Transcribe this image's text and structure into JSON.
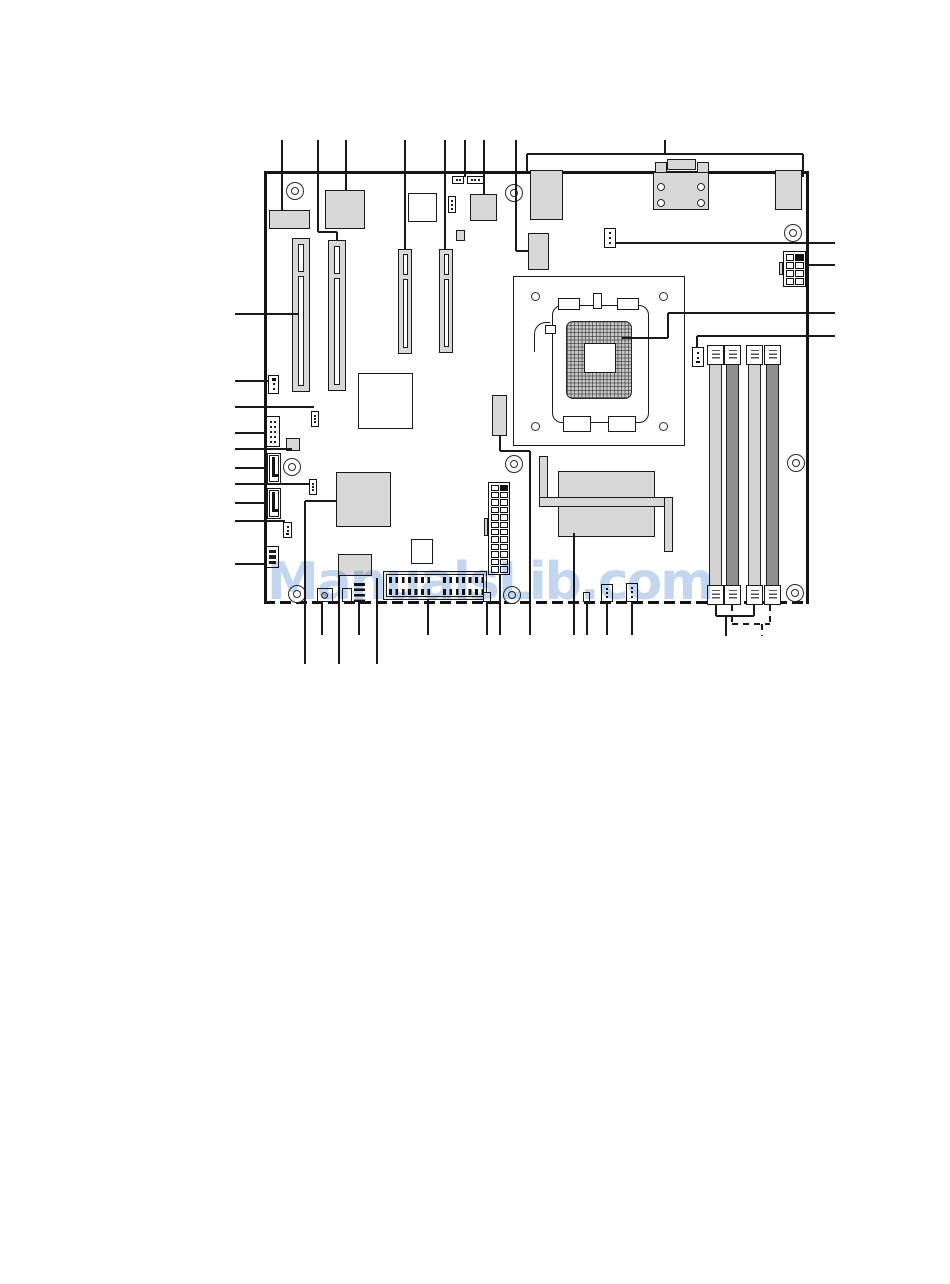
{
  "page": {
    "width": 950,
    "height": 1284,
    "background": "#ffffff"
  },
  "watermark": {
    "text": "ManualsLib.com",
    "color": "#c3d6f0",
    "x": 267,
    "y": 556
  },
  "colors": {
    "line": "#1a1a1a",
    "board_edge": "#151515",
    "block_fill": "#d8d8d8",
    "dimm_light": "#d2d2d2",
    "dimm_dark": "#8f8f8f",
    "hatch_fill": "#c7c7c7"
  },
  "board": {
    "x": 264,
    "y": 171,
    "w": 544,
    "h": 433,
    "bottom_style": "dashed"
  },
  "mount_holes": [
    [
      295,
      191
    ],
    [
      514,
      193
    ],
    [
      793,
      233
    ],
    [
      292,
      467
    ],
    [
      514,
      464
    ],
    [
      796,
      463
    ],
    [
      297,
      594
    ],
    [
      512,
      595
    ],
    [
      795,
      593
    ]
  ],
  "components": [
    {
      "n": "rear-io-port-left",
      "t": "r",
      "f": "g",
      "b": [
        269,
        210,
        41,
        19
      ]
    },
    {
      "n": "lan-controller-chip",
      "t": "r",
      "f": "g",
      "b": [
        325,
        190,
        40,
        39
      ]
    },
    {
      "n": "chip-outline-top",
      "t": "r",
      "f": "w",
      "b": [
        408,
        193,
        29,
        29
      ]
    },
    {
      "n": "jumper-block-a",
      "t": "hdr",
      "b": [
        452,
        176,
        12,
        8
      ],
      "c": 2,
      "r": 1
    },
    {
      "n": "jumper-block-b",
      "t": "hdr",
      "b": [
        467,
        176,
        17,
        8
      ],
      "c": 3,
      "r": 1
    },
    {
      "n": "jumper-3pin-top",
      "t": "hdr",
      "b": [
        448,
        196,
        8,
        17
      ],
      "c": 1,
      "r": 3,
      "dk": "b"
    },
    {
      "n": "clock-chip",
      "t": "r",
      "f": "g",
      "b": [
        470,
        194,
        27,
        27
      ]
    },
    {
      "n": "chip-small-top",
      "t": "r",
      "f": "g",
      "b": [
        456,
        230,
        9,
        11
      ]
    },
    {
      "n": "rear-io-port-usb",
      "t": "r",
      "f": "g",
      "b": [
        530,
        170,
        33,
        50
      ]
    },
    {
      "n": "connector-block-mid",
      "t": "r",
      "f": "g",
      "b": [
        528,
        233,
        21,
        37
      ]
    },
    {
      "n": "serial-port-tab-left",
      "t": "r",
      "f": "g",
      "b": [
        655,
        162,
        12,
        11
      ]
    },
    {
      "n": "serial-port-top",
      "t": "r",
      "f": "g",
      "b": [
        667,
        159,
        29,
        11
      ]
    },
    {
      "n": "serial-port-tab-right",
      "t": "r",
      "f": "g",
      "b": [
        697,
        162,
        12,
        11
      ]
    },
    {
      "n": "serial-port-body",
      "t": "r",
      "f": "g",
      "b": [
        653,
        172,
        56,
        38
      ]
    },
    {
      "n": "serial-port-screw",
      "t": "circ",
      "b": [
        661,
        187,
        4
      ]
    },
    {
      "n": "serial-port-screw",
      "t": "circ",
      "b": [
        661,
        203,
        4
      ]
    },
    {
      "n": "serial-port-screw",
      "t": "circ",
      "b": [
        701,
        187,
        4
      ]
    },
    {
      "n": "serial-port-screw",
      "t": "circ",
      "b": [
        701,
        203,
        4
      ]
    },
    {
      "n": "rear-io-port-right",
      "t": "r",
      "f": "g",
      "b": [
        775,
        170,
        27,
        40
      ]
    },
    {
      "n": "fan-header-rear",
      "t": "hdr",
      "b": [
        604,
        228,
        12,
        20
      ],
      "c": 1,
      "r": 3
    },
    {
      "n": "cpu-power-8pin",
      "t": "grid",
      "b": [
        783,
        251,
        23,
        36
      ],
      "c": 2,
      "r": 4,
      "dark": [
        1
      ]
    },
    {
      "n": "cpu-power-tab",
      "t": "r",
      "f": "g",
      "b": [
        779,
        262,
        4,
        13
      ]
    },
    {
      "n": "pci-slot-1",
      "t": "r",
      "f": "g",
      "b": [
        292,
        238,
        18,
        154
      ]
    },
    {
      "n": "pci-slot-1-key",
      "t": "r",
      "f": "w",
      "b": [
        298,
        244,
        6,
        28
      ]
    },
    {
      "n": "pci-slot-1-main",
      "t": "r",
      "f": "w",
      "b": [
        298,
        276,
        6,
        110
      ]
    },
    {
      "n": "pci-slot-2",
      "t": "r",
      "f": "g",
      "b": [
        328,
        240,
        18,
        151
      ]
    },
    {
      "n": "pci-slot-2-key",
      "t": "r",
      "f": "w",
      "b": [
        334,
        246,
        6,
        28
      ]
    },
    {
      "n": "pci-slot-2-main",
      "t": "r",
      "f": "w",
      "b": [
        334,
        278,
        6,
        107
      ]
    },
    {
      "n": "pcie-slot-1",
      "t": "r",
      "f": "g",
      "b": [
        398,
        249,
        14,
        105
      ]
    },
    {
      "n": "pcie-slot-1-key",
      "t": "r",
      "f": "w",
      "b": [
        403,
        254,
        5,
        21
      ]
    },
    {
      "n": "pcie-slot-1-main",
      "t": "r",
      "f": "w",
      "b": [
        403,
        279,
        5,
        69
      ]
    },
    {
      "n": "pcie-slot-2",
      "t": "r",
      "f": "g",
      "b": [
        439,
        249,
        14,
        104
      ]
    },
    {
      "n": "pcie-slot-2-key",
      "t": "r",
      "f": "w",
      "b": [
        444,
        254,
        5,
        21
      ]
    },
    {
      "n": "pcie-slot-2-main",
      "t": "r",
      "f": "w",
      "b": [
        444,
        279,
        5,
        68
      ]
    },
    {
      "n": "cpu-socket-outline",
      "t": "r",
      "f": "w",
      "b": [
        513,
        276,
        172,
        170
      ]
    },
    {
      "n": "socket-corner-hole",
      "t": "circ",
      "b": [
        535,
        296,
        4.5
      ]
    },
    {
      "n": "socket-corner-hole",
      "t": "circ",
      "b": [
        663,
        296,
        4.5
      ]
    },
    {
      "n": "socket-corner-hole",
      "t": "circ",
      "b": [
        535,
        426,
        4.5
      ]
    },
    {
      "n": "socket-corner-hole",
      "t": "circ",
      "b": [
        663,
        426,
        4.5
      ]
    },
    {
      "n": "cpu-socket-body",
      "t": "round",
      "b": [
        552,
        305,
        97,
        118
      ]
    },
    {
      "n": "socket-cam-left",
      "t": "r",
      "f": "w",
      "b": [
        558,
        298,
        22,
        12
      ]
    },
    {
      "n": "socket-cam-right",
      "t": "r",
      "f": "w",
      "b": [
        617,
        298,
        22,
        12
      ]
    },
    {
      "n": "socket-pin-tab",
      "t": "r",
      "f": "w",
      "b": [
        593,
        293,
        9,
        16
      ]
    },
    {
      "n": "socket-lever",
      "t": "corner",
      "b": [
        534,
        322,
        16,
        30
      ]
    },
    {
      "n": "socket-lever-tab",
      "t": "r",
      "f": "w",
      "b": [
        545,
        325,
        11,
        9
      ]
    },
    {
      "n": "cpu-pad-array",
      "t": "hatch",
      "b": [
        566,
        321,
        66,
        78
      ]
    },
    {
      "n": "cpu-pad-center",
      "t": "r",
      "f": "w",
      "b": [
        584,
        343,
        32,
        30
      ]
    },
    {
      "n": "socket-tab-bottom-left",
      "t": "r",
      "f": "w",
      "b": [
        563,
        416,
        28,
        16
      ]
    },
    {
      "n": "socket-tab-bottom-right",
      "t": "r",
      "f": "w",
      "b": [
        608,
        416,
        28,
        16
      ]
    },
    {
      "n": "dimm-slot-1",
      "t": "r",
      "f": "l",
      "b": [
        709,
        345,
        13,
        260
      ]
    },
    {
      "n": "dimm-slot-2",
      "t": "r",
      "f": "k",
      "b": [
        726,
        345,
        13,
        260
      ]
    },
    {
      "n": "dimm-slot-3",
      "t": "r",
      "f": "l",
      "b": [
        748,
        345,
        13,
        260
      ]
    },
    {
      "n": "dimm-slot-4",
      "t": "r",
      "f": "k",
      "b": [
        766,
        345,
        13,
        260
      ]
    },
    {
      "n": "dimm-latch",
      "t": "latch",
      "b": [
        707,
        345,
        17,
        20
      ]
    },
    {
      "n": "dimm-latch",
      "t": "latch",
      "b": [
        724,
        345,
        17,
        20
      ]
    },
    {
      "n": "dimm-latch",
      "t": "latch",
      "b": [
        746,
        345,
        17,
        20
      ]
    },
    {
      "n": "dimm-latch",
      "t": "latch",
      "b": [
        764,
        345,
        17,
        20
      ]
    },
    {
      "n": "dimm-latch",
      "t": "latch",
      "b": [
        707,
        585,
        17,
        20
      ]
    },
    {
      "n": "dimm-latch",
      "t": "latch",
      "b": [
        724,
        585,
        17,
        20
      ]
    },
    {
      "n": "dimm-latch",
      "t": "latch",
      "b": [
        746,
        585,
        17,
        20
      ]
    },
    {
      "n": "dimm-latch",
      "t": "latch",
      "b": [
        764,
        585,
        17,
        20
      ]
    },
    {
      "n": "fan-header-memory",
      "t": "hdr",
      "b": [
        692,
        347,
        12,
        20
      ],
      "c": 1,
      "r": 3,
      "dk": "b"
    },
    {
      "n": "vrm-bar",
      "t": "r",
      "f": "g",
      "b": [
        492,
        395,
        15,
        41
      ]
    },
    {
      "n": "heatsink-block",
      "t": "r",
      "f": "g",
      "b": [
        558,
        471,
        97,
        66
      ]
    },
    {
      "n": "heatpipe-left",
      "t": "r",
      "f": "g",
      "b": [
        539,
        456,
        9,
        47
      ]
    },
    {
      "n": "heatpipe-bottom",
      "t": "r",
      "f": "g",
      "b": [
        539,
        497,
        134,
        10
      ]
    },
    {
      "n": "heatpipe-right",
      "t": "r",
      "f": "g",
      "b": [
        664,
        497,
        9,
        55
      ]
    },
    {
      "n": "atx-power-24pin",
      "t": "grid",
      "b": [
        488,
        482,
        22,
        93
      ],
      "c": 2,
      "r": 12,
      "dark": [
        1
      ]
    },
    {
      "n": "atx-power-tab",
      "t": "r",
      "f": "g",
      "b": [
        484,
        518,
        4,
        18
      ]
    },
    {
      "n": "northbridge-chip",
      "t": "r",
      "f": "w",
      "b": [
        358,
        373,
        55,
        56
      ]
    },
    {
      "n": "southbridge-chip",
      "t": "r",
      "f": "g",
      "b": [
        336,
        472,
        55,
        55
      ]
    },
    {
      "n": "io-controller-chip",
      "t": "r",
      "f": "g",
      "b": [
        338,
        554,
        34,
        22
      ]
    },
    {
      "n": "bios-chip",
      "t": "r",
      "f": "w",
      "b": [
        411,
        539,
        22,
        25
      ]
    },
    {
      "n": "header-4pin-left",
      "t": "hdr",
      "b": [
        268,
        375,
        11,
        19
      ],
      "c": 1,
      "r": 3,
      "dk": "t"
    },
    {
      "n": "jumper-a",
      "t": "hdr",
      "b": [
        311,
        411,
        8,
        16
      ],
      "c": 1,
      "r": 3
    },
    {
      "n": "header-2x5-left",
      "t": "hdr",
      "b": [
        266,
        416,
        14,
        31
      ],
      "c": 2,
      "r": 5
    },
    {
      "n": "chip-square-left",
      "t": "r",
      "f": "g",
      "b": [
        286,
        438,
        14,
        13
      ]
    },
    {
      "n": "sata-connector-1",
      "t": "r",
      "f": "w",
      "b": [
        267,
        453,
        14,
        31
      ]
    },
    {
      "n": "sata-1-inner",
      "t": "r",
      "f": "w",
      "b": [
        269,
        455,
        10,
        27
      ]
    },
    {
      "n": "sata-1-key",
      "t": "r",
      "f": "d",
      "b": [
        272,
        457,
        3,
        19
      ]
    },
    {
      "n": "sata-1-foot",
      "t": "r",
      "f": "d",
      "b": [
        272,
        474,
        6,
        3
      ]
    },
    {
      "n": "jumper-b",
      "t": "hdr",
      "b": [
        309,
        479,
        8,
        16
      ],
      "c": 1,
      "r": 3
    },
    {
      "n": "sata-connector-2",
      "t": "r",
      "f": "w",
      "b": [
        267,
        488,
        14,
        31
      ]
    },
    {
      "n": "sata-2-inner",
      "t": "r",
      "f": "w",
      "b": [
        269,
        490,
        10,
        27
      ]
    },
    {
      "n": "sata-2-key",
      "t": "r",
      "f": "d",
      "b": [
        272,
        492,
        3,
        19
      ]
    },
    {
      "n": "sata-2-foot",
      "t": "r",
      "f": "d",
      "b": [
        272,
        509,
        6,
        3
      ]
    },
    {
      "n": "header-3pin-left",
      "t": "hdr",
      "b": [
        283,
        522,
        9,
        16
      ],
      "c": 1,
      "r": 3,
      "dk": "b"
    },
    {
      "n": "header-2x3-left",
      "t": "hdr",
      "b": [
        266,
        546,
        13,
        22
      ],
      "c": 2,
      "r": 3,
      "big": true
    },
    {
      "n": "conn-bottom-1",
      "t": "r",
      "f": "w",
      "b": [
        317,
        588,
        16,
        14
      ]
    },
    {
      "n": "conn-bottom-1-dot",
      "t": "circ",
      "b": [
        324,
        595,
        3.5
      ],
      "f": "g"
    },
    {
      "n": "conn-bottom-2",
      "t": "r",
      "f": "w",
      "b": [
        342,
        588,
        10,
        14
      ]
    },
    {
      "n": "audio-header-bars",
      "t": "bars",
      "b": [
        354,
        581,
        11,
        21
      ]
    },
    {
      "n": "front-panel-connector",
      "t": "r",
      "f": "e",
      "b": [
        383,
        571,
        104,
        29
      ]
    },
    {
      "n": "front-panel-inner",
      "t": "r",
      "f": "w",
      "b": [
        386,
        574,
        98,
        23
      ]
    },
    {
      "n": "front-panel-pins",
      "t": "pins",
      "b": [
        389,
        577,
        45,
        6
      ]
    },
    {
      "n": "front-panel-pins",
      "t": "pins",
      "b": [
        443,
        577,
        40,
        6
      ]
    },
    {
      "n": "front-panel-pins",
      "t": "pins",
      "b": [
        389,
        589,
        45,
        6
      ]
    },
    {
      "n": "front-panel-pins",
      "t": "pins",
      "b": [
        443,
        589,
        40,
        6
      ]
    },
    {
      "n": "conn-2pin-bottom",
      "t": "r",
      "f": "w",
      "b": [
        483,
        592,
        8,
        10
      ]
    },
    {
      "n": "conn-tiny-bottom",
      "t": "r",
      "f": "w",
      "b": [
        583,
        592,
        7,
        10
      ]
    },
    {
      "n": "conn-io-1",
      "t": "hdr",
      "b": [
        601,
        584,
        12,
        18
      ],
      "c": 1,
      "r": 3
    },
    {
      "n": "conn-io-2",
      "t": "hdr",
      "b": [
        626,
        583,
        12,
        19
      ],
      "c": 1,
      "r": 3
    }
  ],
  "callout_lines": [
    [
      282,
      140,
      282,
      210
    ],
    [
      318,
      140,
      318,
      232
    ],
    [
      318,
      232,
      337,
      232
    ],
    [
      337,
      232,
      337,
      240
    ],
    [
      346,
      140,
      346,
      190
    ],
    [
      405,
      140,
      405,
      249
    ],
    [
      445,
      140,
      445,
      249
    ],
    [
      465,
      140,
      465,
      177
    ],
    [
      484,
      140,
      484,
      194
    ],
    [
      516,
      140,
      516,
      251
    ],
    [
      516,
      251,
      528,
      251
    ],
    [
      665,
      140,
      665,
      154
    ],
    [
      527,
      154,
      803,
      154
    ],
    [
      527,
      154,
      527,
      172
    ],
    [
      803,
      154,
      803,
      177
    ],
    [
      616,
      243,
      835,
      243
    ],
    [
      806,
      265,
      835,
      265
    ],
    [
      622,
      338,
      668,
      338
    ],
    [
      668,
      313,
      668,
      338
    ],
    [
      668,
      313,
      835,
      313
    ],
    [
      697,
      336,
      835,
      336
    ],
    [
      697,
      336,
      697,
      347
    ],
    [
      235,
      314,
      298,
      314
    ],
    [
      235,
      381,
      268,
      381
    ],
    [
      235,
      407,
      314,
      407
    ],
    [
      235,
      433,
      266,
      433
    ],
    [
      235,
      449,
      292,
      449
    ],
    [
      235,
      468,
      267,
      468
    ],
    [
      235,
      484,
      309,
      484
    ],
    [
      235,
      503,
      267,
      503
    ],
    [
      235,
      521,
      285,
      521
    ],
    [
      235,
      564,
      266,
      564
    ],
    [
      305,
      501,
      336,
      501
    ],
    [
      305,
      501,
      305,
      664
    ],
    [
      322,
      602,
      322,
      635
    ],
    [
      339,
      576,
      339,
      664
    ],
    [
      359,
      602,
      359,
      635
    ],
    [
      377,
      578,
      377,
      664
    ],
    [
      428,
      600,
      428,
      635
    ],
    [
      487,
      602,
      487,
      635
    ],
    [
      500,
      575,
      500,
      635
    ],
    [
      500,
      436,
      500,
      451
    ],
    [
      500,
      451,
      530,
      451
    ],
    [
      530,
      451,
      530,
      635
    ],
    [
      574,
      533,
      574,
      635
    ],
    [
      587,
      602,
      587,
      635
    ],
    [
      607,
      602,
      607,
      635
    ],
    [
      632,
      602,
      632,
      635
    ],
    [
      716,
      605,
      716,
      616
    ],
    [
      754,
      605,
      754,
      616
    ],
    [
      716,
      616,
      754,
      616
    ],
    [
      726,
      616,
      726,
      636
    ],
    [
      732,
      605,
      732,
      624,
      1
    ],
    [
      770,
      605,
      770,
      624,
      1
    ],
    [
      732,
      624,
      770,
      624,
      1
    ],
    [
      762,
      624,
      762,
      636,
      1
    ]
  ]
}
